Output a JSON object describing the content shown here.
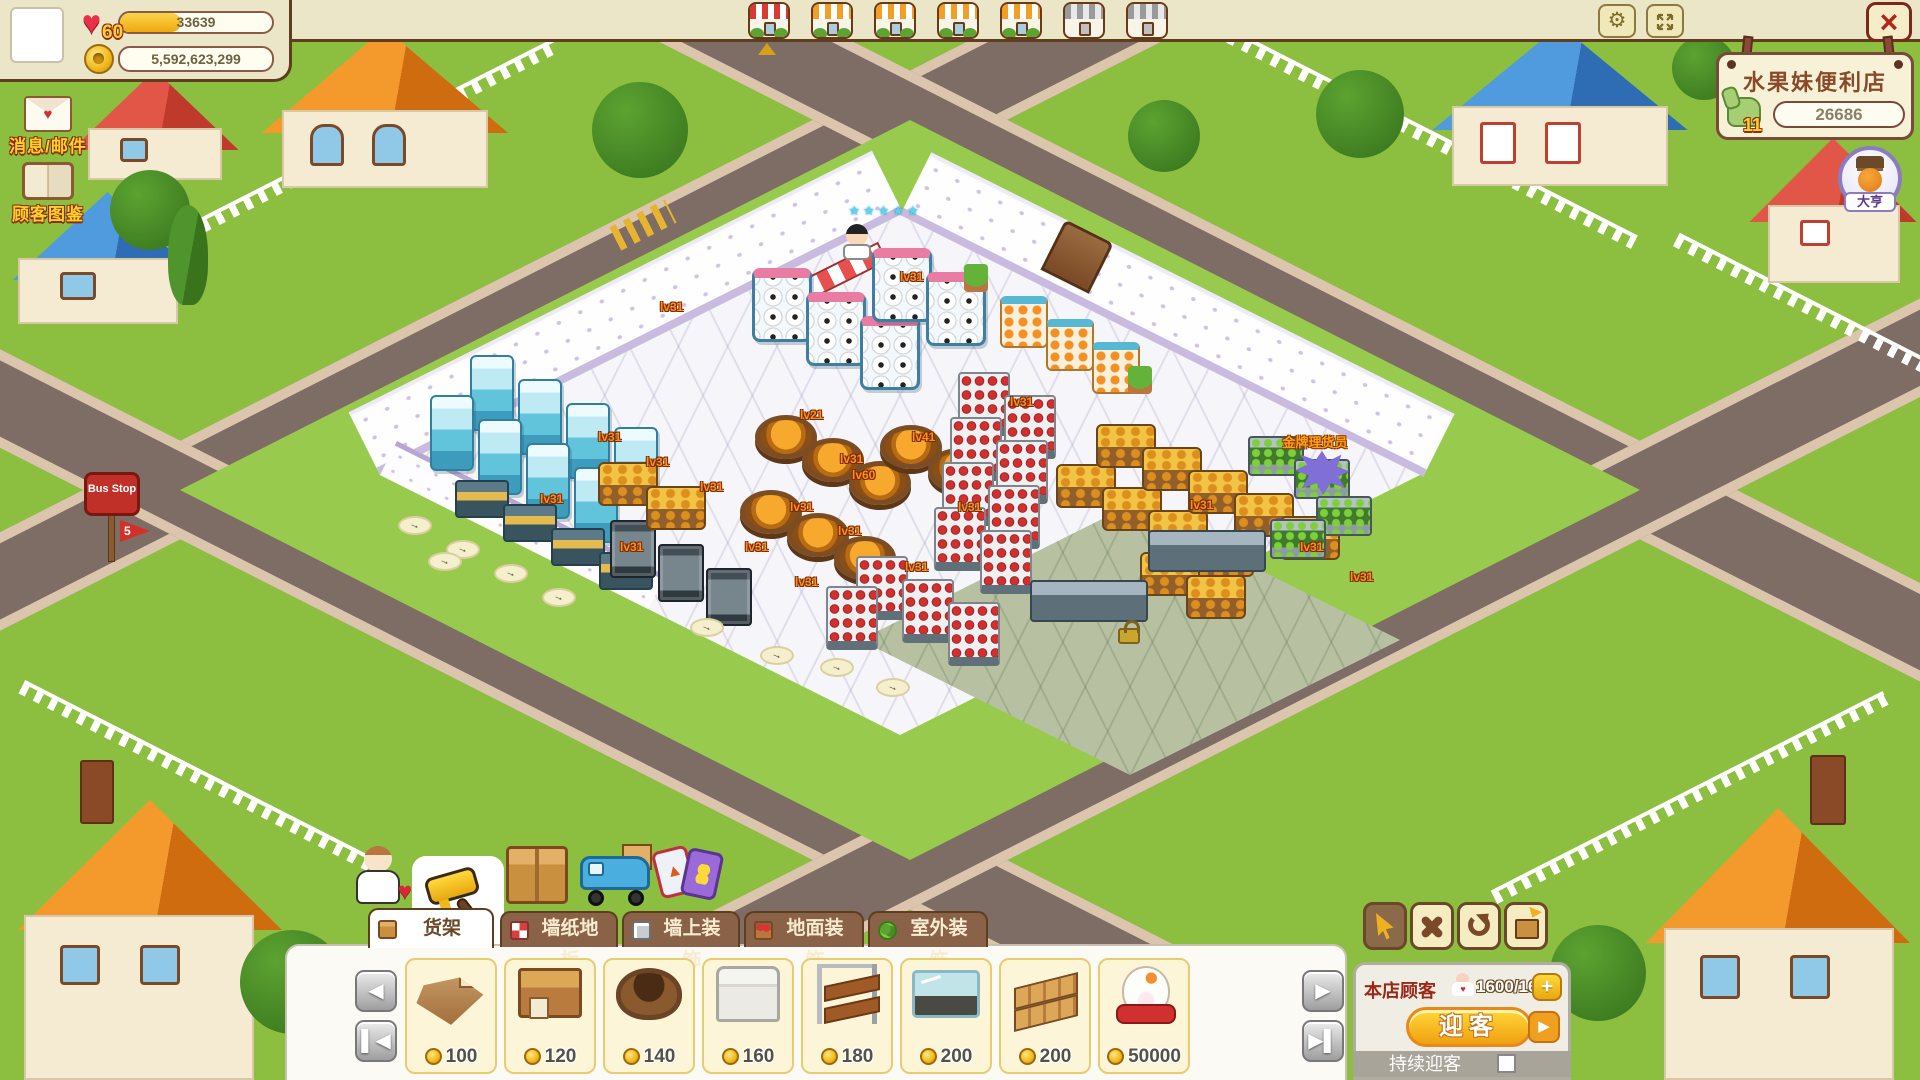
{
  "player": {
    "level": "60",
    "xp": "33639",
    "coins": "5,592,623,299"
  },
  "left_menu": {
    "mail_label": "消息/邮件",
    "catalog_label": "顾客图鉴"
  },
  "shop_tabs": {
    "tabs": [
      {
        "style": "red",
        "state": "active"
      },
      {
        "style": "orange",
        "state": "unlocked"
      },
      {
        "style": "orange",
        "state": "unlocked"
      },
      {
        "style": "orange",
        "state": "unlocked"
      },
      {
        "style": "orange",
        "state": "unlocked"
      },
      {
        "style": "gray",
        "state": "locked"
      },
      {
        "style": "gray",
        "state": "locked"
      }
    ]
  },
  "store_sign": {
    "name": "水果妹便利店",
    "level": "11",
    "likes": "26686"
  },
  "owner_badge": {
    "title": "大亨"
  },
  "bus_stop": {
    "label": "Bus Stop",
    "line": "5"
  },
  "scene": {
    "staff_stars": "★★★★★",
    "npc_label": "金牌理货员",
    "level_labels": [
      {
        "text": "lv31",
        "x": 598,
        "y": 430
      },
      {
        "text": "lv31",
        "x": 646,
        "y": 455
      },
      {
        "text": "lv31",
        "x": 700,
        "y": 480
      },
      {
        "text": "lv31",
        "x": 540,
        "y": 492
      },
      {
        "text": "lv31",
        "x": 620,
        "y": 540
      },
      {
        "text": "lv21",
        "x": 800,
        "y": 408
      },
      {
        "text": "lv31",
        "x": 840,
        "y": 452
      },
      {
        "text": "lv41",
        "x": 912,
        "y": 430
      },
      {
        "text": "lv60",
        "x": 852,
        "y": 468
      },
      {
        "text": "lv31",
        "x": 790,
        "y": 500
      },
      {
        "text": "lv31",
        "x": 838,
        "y": 524
      },
      {
        "text": "lv31",
        "x": 745,
        "y": 540
      },
      {
        "text": "lv31",
        "x": 795,
        "y": 575
      },
      {
        "text": "lv31",
        "x": 1010,
        "y": 395
      },
      {
        "text": "lv31",
        "x": 958,
        "y": 500
      },
      {
        "text": "lv31",
        "x": 905,
        "y": 560
      },
      {
        "text": "lv31",
        "x": 1190,
        "y": 498
      },
      {
        "text": "lv31",
        "x": 1300,
        "y": 540
      },
      {
        "text": "lv31",
        "x": 1350,
        "y": 570
      },
      {
        "text": "lv31",
        "x": 660,
        "y": 300
      },
      {
        "text": "lv31",
        "x": 900,
        "y": 270
      }
    ],
    "props": [
      {
        "t": "freezer2",
        "x": 470,
        "y": 355
      },
      {
        "t": "freezer2",
        "x": 518,
        "y": 379
      },
      {
        "t": "freezer2",
        "x": 566,
        "y": 403
      },
      {
        "t": "freezer2",
        "x": 614,
        "y": 427
      },
      {
        "t": "freezer2",
        "x": 430,
        "y": 395
      },
      {
        "t": "freezer2",
        "x": 478,
        "y": 419
      },
      {
        "t": "freezer2",
        "x": 526,
        "y": 443
      },
      {
        "t": "freezer2",
        "x": 574,
        "y": 467
      },
      {
        "t": "soccer",
        "x": 752,
        "y": 268
      },
      {
        "t": "soccer",
        "x": 806,
        "y": 292
      },
      {
        "t": "soccer",
        "x": 860,
        "y": 316
      },
      {
        "t": "soccer",
        "x": 872,
        "y": 248
      },
      {
        "t": "soccer",
        "x": 926,
        "y": 272
      },
      {
        "t": "chest",
        "x": 455,
        "y": 480
      },
      {
        "t": "chest",
        "x": 503,
        "y": 504
      },
      {
        "t": "chest",
        "x": 551,
        "y": 528
      },
      {
        "t": "chest",
        "x": 599,
        "y": 552
      },
      {
        "t": "dark",
        "x": 610,
        "y": 520
      },
      {
        "t": "dark",
        "x": 658,
        "y": 544
      },
      {
        "t": "dark",
        "x": 706,
        "y": 568
      },
      {
        "t": "barrel",
        "x": 755,
        "y": 415
      },
      {
        "t": "barrel",
        "x": 802,
        "y": 438
      },
      {
        "t": "barrel",
        "x": 849,
        "y": 461
      },
      {
        "t": "barrel",
        "x": 740,
        "y": 490
      },
      {
        "t": "barrel",
        "x": 787,
        "y": 513
      },
      {
        "t": "barrel",
        "x": 834,
        "y": 536
      },
      {
        "t": "barrel",
        "x": 880,
        "y": 425
      },
      {
        "t": "barrel",
        "x": 928,
        "y": 448
      },
      {
        "t": "gold",
        "x": 598,
        "y": 462
      },
      {
        "t": "gold",
        "x": 646,
        "y": 486
      },
      {
        "t": "red",
        "x": 958,
        "y": 372
      },
      {
        "t": "red",
        "x": 1004,
        "y": 395
      },
      {
        "t": "red",
        "x": 950,
        "y": 417
      },
      {
        "t": "red",
        "x": 996,
        "y": 440
      },
      {
        "t": "red",
        "x": 942,
        "y": 462
      },
      {
        "t": "red",
        "x": 988,
        "y": 485
      },
      {
        "t": "red",
        "x": 934,
        "y": 507
      },
      {
        "t": "red",
        "x": 980,
        "y": 530
      },
      {
        "t": "red",
        "x": 856,
        "y": 556
      },
      {
        "t": "red",
        "x": 902,
        "y": 579
      },
      {
        "t": "red",
        "x": 948,
        "y": 602
      },
      {
        "t": "red",
        "x": 826,
        "y": 586
      },
      {
        "t": "gold",
        "x": 1056,
        "y": 464
      },
      {
        "t": "gold",
        "x": 1102,
        "y": 487
      },
      {
        "t": "gold",
        "x": 1148,
        "y": 510
      },
      {
        "t": "gold",
        "x": 1194,
        "y": 533
      },
      {
        "t": "gold",
        "x": 1096,
        "y": 424
      },
      {
        "t": "gold",
        "x": 1142,
        "y": 447
      },
      {
        "t": "gold",
        "x": 1188,
        "y": 470
      },
      {
        "t": "gold",
        "x": 1234,
        "y": 493
      },
      {
        "t": "gold",
        "x": 1280,
        "y": 516
      },
      {
        "t": "gold",
        "x": 1140,
        "y": 552
      },
      {
        "t": "gold",
        "x": 1186,
        "y": 575
      },
      {
        "t": "veg",
        "x": 1248,
        "y": 436
      },
      {
        "t": "veg",
        "x": 1294,
        "y": 459
      },
      {
        "t": "veg",
        "x": 1316,
        "y": 496
      },
      {
        "t": "veg",
        "x": 1270,
        "y": 519
      },
      {
        "t": "fruit",
        "x": 1000,
        "y": 296
      },
      {
        "t": "fruit",
        "x": 1046,
        "y": 319
      },
      {
        "t": "fruit",
        "x": 1092,
        "y": 342
      },
      {
        "t": "plant",
        "x": 964,
        "y": 264
      },
      {
        "t": "plant",
        "x": 1128,
        "y": 366
      },
      {
        "t": "steel",
        "x": 1030,
        "y": 580
      },
      {
        "t": "steel",
        "x": 1148,
        "y": 530
      },
      {
        "t": "arrow",
        "x": 398,
        "y": 516
      },
      {
        "t": "arrow",
        "x": 446,
        "y": 540
      },
      {
        "t": "arrow",
        "x": 494,
        "y": 564
      },
      {
        "t": "arrow",
        "x": 542,
        "y": 588
      },
      {
        "t": "arrow",
        "x": 428,
        "y": 552
      },
      {
        "t": "arrow",
        "x": 690,
        "y": 618
      },
      {
        "t": "arrow",
        "x": 760,
        "y": 646
      },
      {
        "t": "arrow",
        "x": 820,
        "y": 658
      },
      {
        "t": "arrow",
        "x": 876,
        "y": 678
      },
      {
        "t": "npc",
        "x": 1295,
        "y": 450
      },
      {
        "t": "lock",
        "x": 1118,
        "y": 628
      }
    ]
  },
  "toolbar": {
    "categories": [
      "friends",
      "decorate",
      "storage",
      "delivery",
      "cards"
    ],
    "tools": [
      "cursor",
      "move",
      "rotate",
      "store-item"
    ],
    "tabs": [
      {
        "label": "货架",
        "active": true
      },
      {
        "label": "墙纸地板",
        "active": false
      },
      {
        "label": "墙上装饰",
        "active": false
      },
      {
        "label": "地面装饰",
        "active": false
      },
      {
        "label": "室外装饰",
        "active": false
      }
    ],
    "items": [
      {
        "type": "wood-stand",
        "price": "100"
      },
      {
        "type": "wood-box",
        "price": "120"
      },
      {
        "type": "barrel",
        "price": "140"
      },
      {
        "type": "white-shelf",
        "price": "160"
      },
      {
        "type": "ladder-rack",
        "price": "180"
      },
      {
        "type": "glass-case",
        "price": "200"
      },
      {
        "type": "wood-pallet",
        "price": "200"
      },
      {
        "type": "lucky-cat",
        "price": "50000"
      }
    ]
  },
  "customer_panel": {
    "label": "本店顾客",
    "count": "1600/1600",
    "welcome": "迎客",
    "continuous": "持续迎客"
  },
  "colors": {
    "accent_gold": "#f0b020",
    "cream": "#ece6c8",
    "brown_line": "#5f3e1f",
    "welcome_orange": "#f0a010"
  }
}
